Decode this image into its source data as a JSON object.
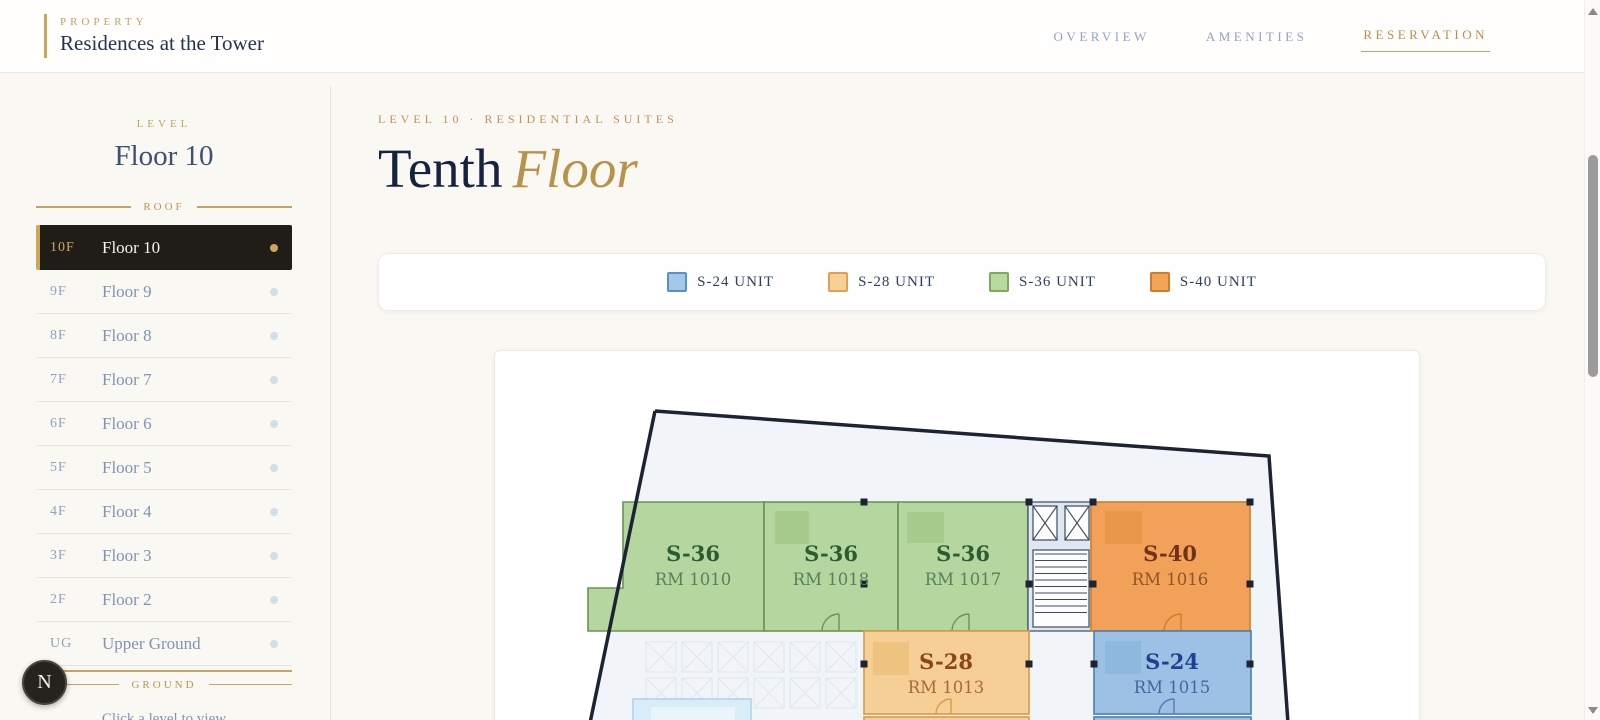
{
  "header": {
    "brand_eyebrow": "PROPERTY",
    "brand_name": "Residences at the Tower",
    "nav": [
      {
        "label": "OVERVIEW"
      },
      {
        "label": "AMENITIES"
      },
      {
        "label": "RESERVATION"
      }
    ]
  },
  "sidebar": {
    "eyebrow": "LEVEL",
    "title": "Floor 10",
    "top_divider": "ROOF",
    "bottom_divider": "GROUND",
    "hint": "Click a level to view",
    "compass": "N",
    "floors": [
      {
        "code": "10F",
        "name": "Floor 10",
        "selected": true
      },
      {
        "code": "9F",
        "name": "Floor 9"
      },
      {
        "code": "8F",
        "name": "Floor 8"
      },
      {
        "code": "7F",
        "name": "Floor 7"
      },
      {
        "code": "6F",
        "name": "Floor 6"
      },
      {
        "code": "5F",
        "name": "Floor 5"
      },
      {
        "code": "4F",
        "name": "Floor 4"
      },
      {
        "code": "3F",
        "name": "Floor 3"
      },
      {
        "code": "2F",
        "name": "Floor 2"
      },
      {
        "code": "UG",
        "name": "Upper Ground"
      }
    ]
  },
  "main": {
    "eyebrow": "LEVEL 10 · RESIDENTIAL SUITES",
    "title_primary": "Tenth",
    "title_accent": "Floor",
    "legend": {
      "items": [
        {
          "label": "S-24 UNIT",
          "fill": "#a6c8e8",
          "border": "#5a8ec6"
        },
        {
          "label": "S-28 UNIT",
          "fill": "#f7d096",
          "border": "#dfa055"
        },
        {
          "label": "S-36 UNIT",
          "fill": "#b9d9a1",
          "border": "#7cab5f"
        },
        {
          "label": "S-40 UNIT",
          "fill": "#f2a457",
          "border": "#d07b2d"
        }
      ]
    },
    "plan": {
      "units": [
        {
          "type": "S-36",
          "room": "RM 1010"
        },
        {
          "type": "S-36",
          "room": "RM 1018"
        },
        {
          "type": "S-36",
          "room": "RM 1017"
        },
        {
          "type": "S-40",
          "room": "RM 1016"
        },
        {
          "type": "S-28",
          "room": "RM 1013"
        },
        {
          "type": "S-24",
          "room": "RM 1015"
        }
      ]
    }
  },
  "colors": {
    "accent_gold": "#c9a85c",
    "navy_text": "#16233f",
    "selected_row_bg": "#201d18",
    "unit_green": "#b6d69f",
    "unit_orange": "#f1a258",
    "unit_tan": "#f6cf96",
    "unit_blue": "#9dc1e5"
  }
}
